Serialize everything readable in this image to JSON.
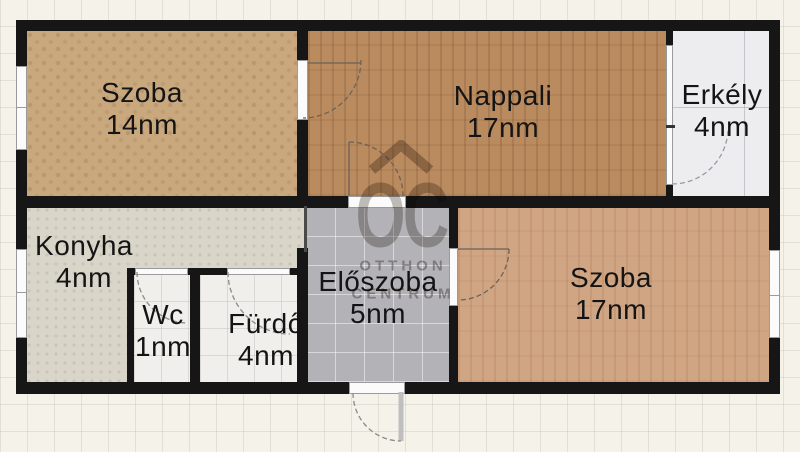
{
  "rooms": [
    {
      "name": "Szoba",
      "area": "14nm",
      "floor_color": "#c9a87e"
    },
    {
      "name": "Nappali",
      "area": "17nm",
      "floor_color": "#ba8b5f"
    },
    {
      "name": "Erkély",
      "area": "4nm",
      "floor_color": "#ededf0"
    },
    {
      "name": "Konyha",
      "area": "4nm",
      "floor_color": "#d9d5c9"
    },
    {
      "name": "Wc",
      "area": "1nm",
      "floor_color": "#f0efec"
    },
    {
      "name": "Fürdő",
      "area": "4nm",
      "floor_color": "#f0efec"
    },
    {
      "name": "Előszoba",
      "area": "5nm",
      "floor_color": "#b3b2b7"
    },
    {
      "name": "Szoba",
      "area": "17nm",
      "floor_color": "#d0a584"
    }
  ],
  "watermark": {
    "logo": "OC",
    "line1": "OTTHON",
    "line2": "CENTRUM"
  },
  "colors": {
    "wall": "#161616",
    "background": "#f5f2e9",
    "grid_line": "#cdc8ba",
    "door_arc": "#6b6258"
  }
}
